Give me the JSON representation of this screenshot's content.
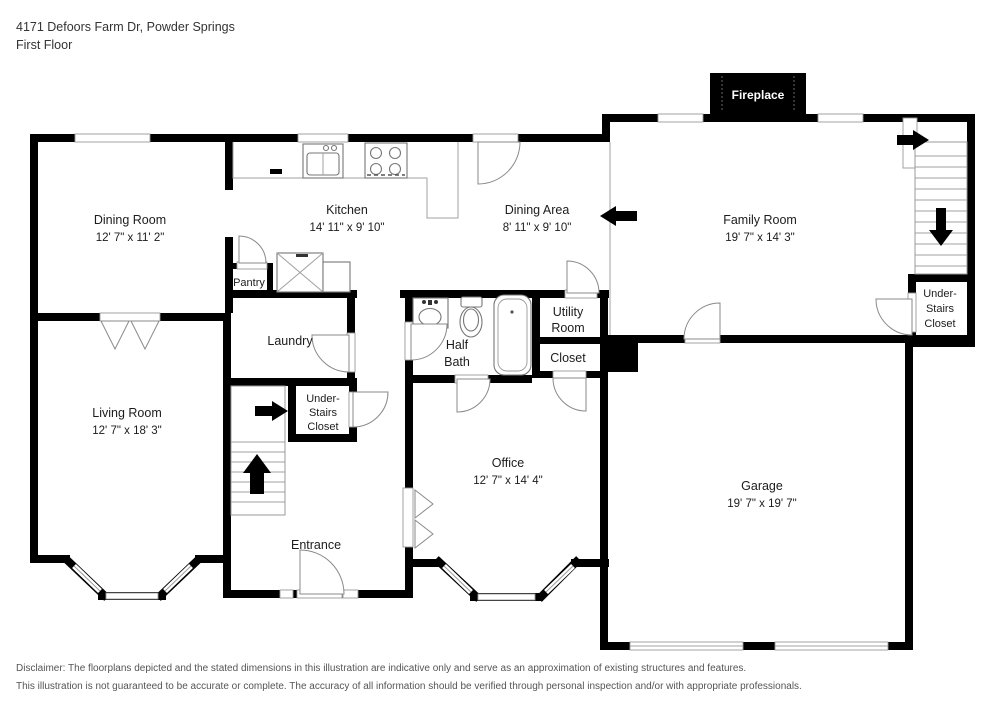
{
  "header": {
    "address": "4171 Defoors Farm Dr, Powder Springs",
    "floor_label": "First Floor"
  },
  "rooms": {
    "dining_room": {
      "name": "Dining Room",
      "dims": "12' 7\" x 11' 2\""
    },
    "kitchen": {
      "name": "Kitchen",
      "dims": "14' 11\" x 9' 10\""
    },
    "dining_area": {
      "name": "Dining Area",
      "dims": "8' 11\" x 9' 10\""
    },
    "family_room": {
      "name": "Family Room",
      "dims": "19' 7\" x 14' 3\""
    },
    "living_room": {
      "name": "Living Room",
      "dims": "12' 7\" x 18' 3\""
    },
    "office": {
      "name": "Office",
      "dims": "12' 7\" x 14' 4\""
    },
    "garage": {
      "name": "Garage",
      "dims": "19' 7\" x 19' 7\""
    },
    "entrance": {
      "name": "Entrance"
    },
    "pantry": {
      "name": "Pantry"
    },
    "laundry": {
      "name": "Laundry"
    },
    "half_bath": {
      "line1": "Half",
      "line2": "Bath"
    },
    "utility_room": {
      "line1": "Utility",
      "line2": "Room"
    },
    "closet": {
      "name": "Closet"
    },
    "under_stairs_closet": {
      "line1": "Under-",
      "line2": "Stairs",
      "line3": "Closet"
    },
    "fireplace": {
      "name": "Fireplace"
    }
  },
  "disclaimer": {
    "line1": "Disclaimer: The floorplans depicted and the stated dimensions in this illustration are indicative only and serve as an approximation of existing structures and features.",
    "line2": "This illustration is not guaranteed to be accurate or complete. The accuracy of all information should be verified through personal inspection and/or with appropriate professionals."
  },
  "colors": {
    "wall": "#000000",
    "thin_line": "#999999",
    "label_text": "#1c1c1c",
    "disclaimer_text": "#555555"
  }
}
